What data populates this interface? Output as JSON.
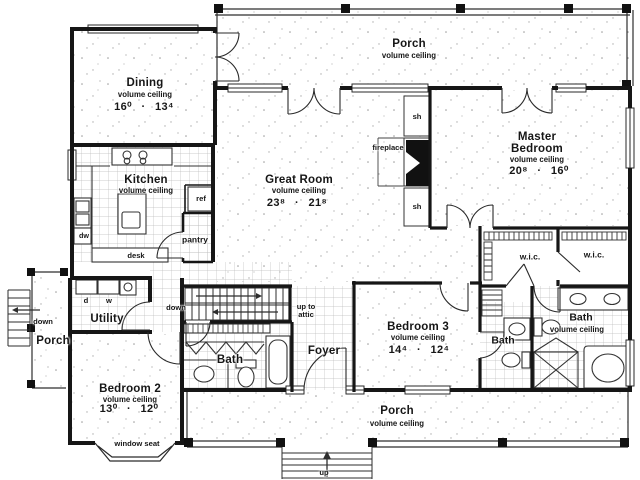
{
  "colors": {
    "wall": "#161616",
    "thin_line": "#2e2e2e",
    "tile_line": "#b8b8b8",
    "speckle": "#9a9a9a",
    "text": "#161616",
    "background": "#ffffff"
  },
  "rooms": [
    {
      "id": "porch-top",
      "name": "Porch",
      "sub": "volume ceiling"
    },
    {
      "id": "dining",
      "name": "Dining",
      "sub": "volume ceiling",
      "dims": "16⁰ · 13⁴"
    },
    {
      "id": "kitchen",
      "name": "Kitchen",
      "sub": "volume ceiling"
    },
    {
      "id": "great-room",
      "name": "Great Room",
      "sub": "volume ceiling",
      "dims": "23⁸ · 21⁸"
    },
    {
      "id": "master-bedroom",
      "name": "Master Bedroom",
      "sub": "volume ceiling",
      "dims": "20⁸ · 16⁰"
    },
    {
      "id": "wic-left",
      "name": "w.i.c."
    },
    {
      "id": "wic-right",
      "name": "w.i.c."
    },
    {
      "id": "master-bath",
      "name": "Bath",
      "sub": "volume ceiling"
    },
    {
      "id": "bedroom-3",
      "name": "Bedroom 3",
      "sub": "volume ceiling",
      "dims": "14⁴ · 12⁴"
    },
    {
      "id": "hall-bath",
      "name": "Bath"
    },
    {
      "id": "foyer",
      "name": "Foyer"
    },
    {
      "id": "middle-bath",
      "name": "Bath"
    },
    {
      "id": "utility",
      "name": "Utility"
    },
    {
      "id": "porch-left",
      "name": "Porch"
    },
    {
      "id": "bedroom-2",
      "name": "Bedroom 2",
      "sub": "volume ceiling",
      "dims": "13⁰ · 12⁰"
    },
    {
      "id": "porch-bottom",
      "name": "Porch",
      "sub": "volume ceiling"
    }
  ],
  "annotations": {
    "fireplace": "fireplace",
    "shelf_top": "sh",
    "shelf_bottom": "sh",
    "refrigerator": "ref",
    "pantry": "pantry",
    "desk": "desk",
    "dishwasher": "dw",
    "dryer": "d",
    "washer": "w",
    "stairs_down": "down",
    "stairs_up_to_attic": "up to attic",
    "porch_down": "down",
    "window_seat": "window seat",
    "entry_steps_up": "up"
  }
}
